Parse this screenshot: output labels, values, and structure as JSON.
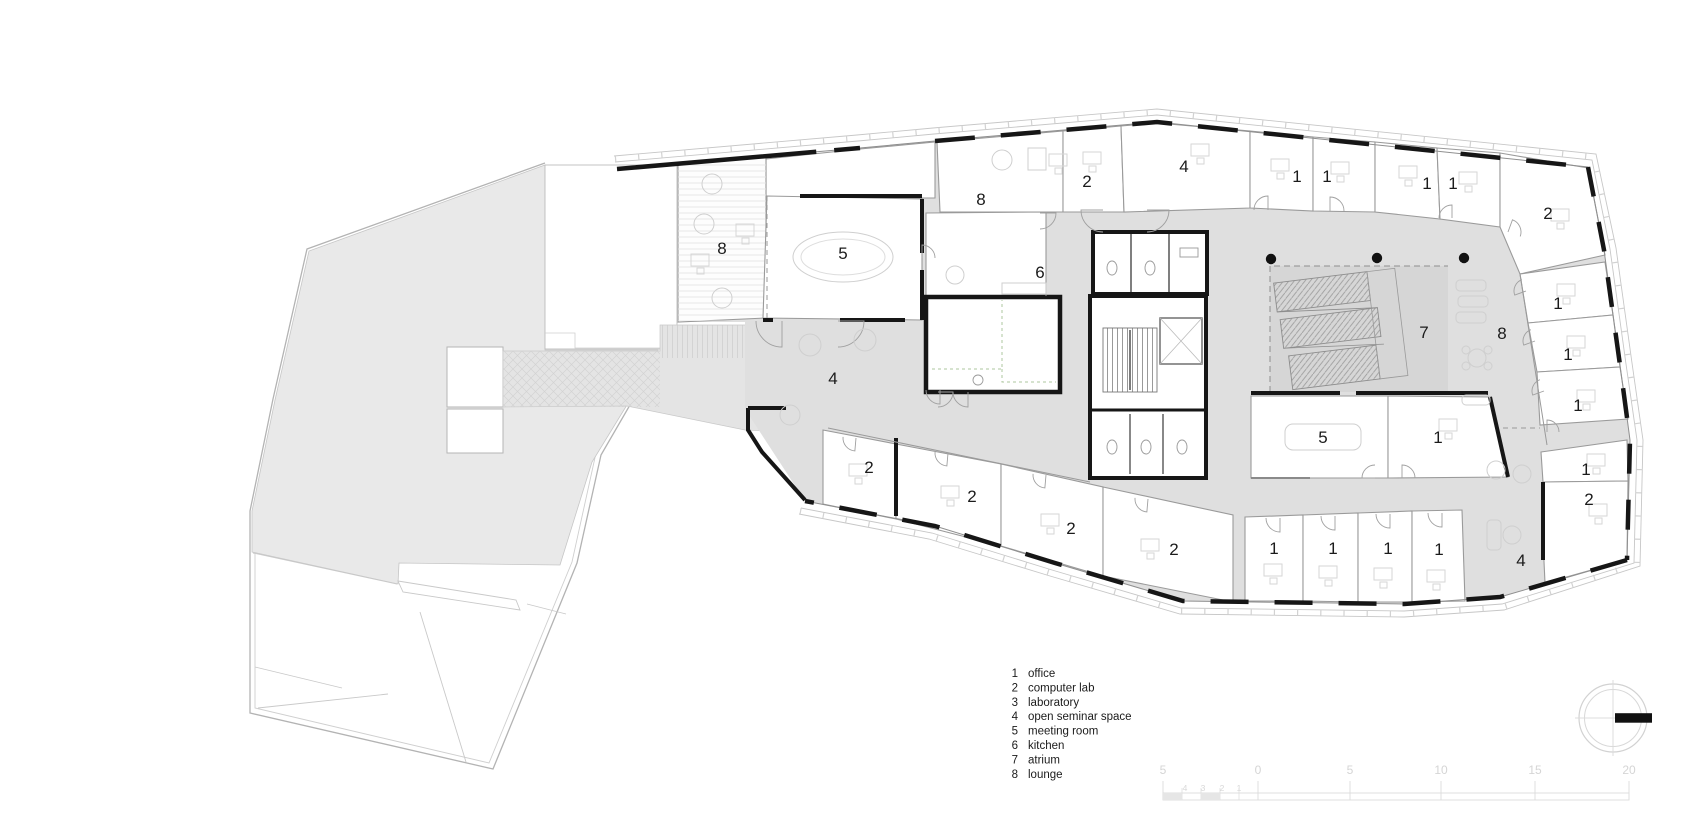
{
  "drawing": {
    "kind": "architectural-floor-plan",
    "background": "#ffffff"
  },
  "colors": {
    "terrace_fill": "#e9e9e9",
    "walkway_fill": "#e4e4e4",
    "corridor_fill": "#dfdfdf",
    "atrium_fill": "#d6d6d6",
    "wall_black": "#161616",
    "partition_gray": "#9a9a9a",
    "outline_gray": "#b3b3b3",
    "furniture_gray": "#d2d2d2",
    "label_color": "#1b1b1b",
    "scale_color": "#d5d5d5",
    "route_dash_green": "#aec79f"
  },
  "room_labels": [
    {
      "n": "8",
      "x": 722,
      "y": 254,
      "name": "lounge-west"
    },
    {
      "n": "5",
      "x": 843,
      "y": 259,
      "name": "meeting-room-northwest"
    },
    {
      "n": "8",
      "x": 981,
      "y": 205,
      "name": "lounge-north"
    },
    {
      "n": "6",
      "x": 1040,
      "y": 278,
      "name": "kitchen"
    },
    {
      "n": "2",
      "x": 1087,
      "y": 187,
      "name": "computer-lab-north"
    },
    {
      "n": "4",
      "x": 1184,
      "y": 172,
      "name": "open-seminar-north"
    },
    {
      "n": "1",
      "x": 1297,
      "y": 182,
      "name": "office-n1"
    },
    {
      "n": "1",
      "x": 1327,
      "y": 182,
      "name": "office-n2"
    },
    {
      "n": "1",
      "x": 1427,
      "y": 189,
      "name": "office-n3"
    },
    {
      "n": "1",
      "x": 1453,
      "y": 189,
      "name": "office-n4"
    },
    {
      "n": "2",
      "x": 1548,
      "y": 219,
      "name": "computer-lab-northeast"
    },
    {
      "n": "1",
      "x": 1558,
      "y": 309,
      "name": "office-e1"
    },
    {
      "n": "7",
      "x": 1424,
      "y": 338,
      "name": "atrium"
    },
    {
      "n": "8",
      "x": 1502,
      "y": 339,
      "name": "lounge-east"
    },
    {
      "n": "1",
      "x": 1568,
      "y": 360,
      "name": "office-e2"
    },
    {
      "n": "1",
      "x": 1578,
      "y": 411,
      "name": "office-e3"
    },
    {
      "n": "4",
      "x": 833,
      "y": 384,
      "name": "open-seminar-west"
    },
    {
      "n": "5",
      "x": 1323,
      "y": 443,
      "name": "meeting-room-south"
    },
    {
      "n": "1",
      "x": 1438,
      "y": 443,
      "name": "office-c1"
    },
    {
      "n": "1",
      "x": 1586,
      "y": 475,
      "name": "office-e4"
    },
    {
      "n": "2",
      "x": 1589,
      "y": 505,
      "name": "computer-lab-east"
    },
    {
      "n": "2",
      "x": 869,
      "y": 473,
      "name": "computer-lab-s1"
    },
    {
      "n": "2",
      "x": 972,
      "y": 502,
      "name": "computer-lab-s2"
    },
    {
      "n": "2",
      "x": 1071,
      "y": 534,
      "name": "computer-lab-s3"
    },
    {
      "n": "2",
      "x": 1174,
      "y": 555,
      "name": "computer-lab-s4"
    },
    {
      "n": "1",
      "x": 1274,
      "y": 554,
      "name": "office-s1"
    },
    {
      "n": "1",
      "x": 1333,
      "y": 554,
      "name": "office-s2"
    },
    {
      "n": "1",
      "x": 1388,
      "y": 554,
      "name": "office-s3"
    },
    {
      "n": "1",
      "x": 1439,
      "y": 555,
      "name": "office-s4"
    },
    {
      "n": "4",
      "x": 1521,
      "y": 566,
      "name": "open-seminar-southeast"
    }
  ],
  "legend": {
    "x_num": 1018,
    "x_text": 1028,
    "y_start": 677,
    "row_h": 14.4,
    "items": [
      {
        "num": "1",
        "label": "office"
      },
      {
        "num": "2",
        "label": "computer lab"
      },
      {
        "num": "3",
        "label": "laboratory"
      },
      {
        "num": "4",
        "label": "open seminar space"
      },
      {
        "num": "5",
        "label": "meeting room"
      },
      {
        "num": "6",
        "label": "kitchen"
      },
      {
        "num": "7",
        "label": "atrium"
      },
      {
        "num": "8",
        "label": "lounge"
      }
    ]
  },
  "scale_bar": {
    "major_labels": [
      {
        "t": "5",
        "x": 1163
      },
      {
        "t": "0",
        "x": 1258
      },
      {
        "t": "5",
        "x": 1350
      },
      {
        "t": "10",
        "x": 1441
      },
      {
        "t": "15",
        "x": 1535
      },
      {
        "t": "20",
        "x": 1629
      }
    ],
    "label_y": 774,
    "sub_labels": [
      {
        "t": "4",
        "x": 1185
      },
      {
        "t": "3",
        "x": 1203
      },
      {
        "t": "2",
        "x": 1222
      },
      {
        "t": "1",
        "x": 1239
      }
    ],
    "sub_label_y": 791,
    "bar_y": 793,
    "bar_h": 7
  },
  "compass": {
    "cx": 1613,
    "cy": 718,
    "r_outer": 34,
    "r_inner": 28.5
  }
}
